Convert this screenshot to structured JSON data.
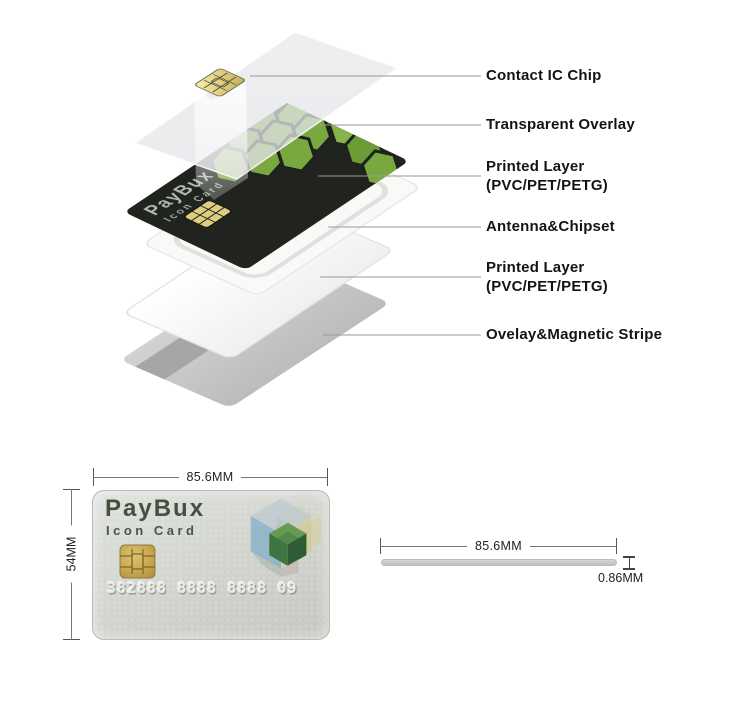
{
  "exploded": {
    "labels": [
      {
        "id": "contact-ic-chip",
        "text": "Contact IC Chip"
      },
      {
        "id": "transparent-overlay",
        "text": "Transparent Overlay"
      },
      {
        "id": "printed-layer-top",
        "text": "Printed Layer\n(PVC/PET/PETG)"
      },
      {
        "id": "antenna-chipset",
        "text": "Antenna&Chipset"
      },
      {
        "id": "printed-layer-bottom",
        "text": "Printed Layer\n(PVC/PET/PETG)"
      },
      {
        "id": "overlay-magnetic-stripe",
        "text": "Ovelay&Magnetic Stripe"
      }
    ],
    "card": {
      "brand": "PayBux",
      "subtitle": "Icon Card"
    }
  },
  "front_card": {
    "brand": "PayBux",
    "subtitle": "Icon Card",
    "number": "382888 8888 8888 09",
    "width_label": "85.6MM",
    "height_label": "54MM"
  },
  "side_profile": {
    "width_label": "85.6MM",
    "thickness_label": "0.86MM"
  },
  "colors": {
    "hex_green": "#79a83e",
    "dark_layer": "#20231e",
    "chip_gold": "#d9c878",
    "leader_line": "#9a9a9a"
  }
}
